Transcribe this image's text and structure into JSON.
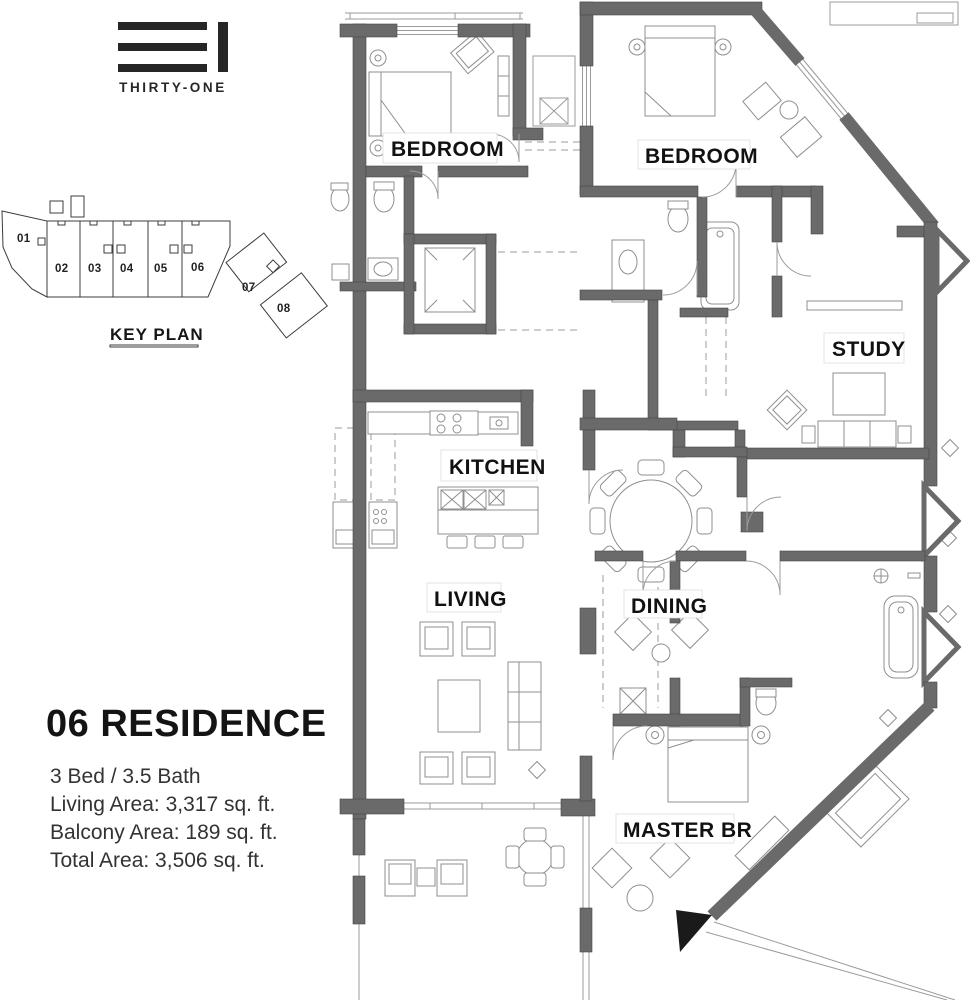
{
  "logo": {
    "name": "THIRTY-ONE"
  },
  "key_plan": {
    "title": "KEY PLAN",
    "units": [
      "01",
      "02",
      "03",
      "04",
      "05",
      "06",
      "07",
      "08"
    ],
    "highlighted_unit": "06"
  },
  "floor_plan": {
    "rooms": [
      "BEDROOM",
      "BEDROOM",
      "STUDY",
      "KITCHEN",
      "LIVING",
      "DINING",
      "MASTER BR"
    ]
  },
  "residence": {
    "title": "06 RESIDENCE",
    "specs": [
      "3 Bed / 3.5 Bath",
      "Living Area: 3,317 sq. ft.",
      "Balcony Area: 189 sq. ft.",
      "Total Area: 3,506 sq. ft."
    ]
  },
  "colors": {
    "wall": "#6a6a6a",
    "thin_line": "#9b9b9b",
    "ink": "#1a1a1a",
    "paper": "#ffffff"
  }
}
